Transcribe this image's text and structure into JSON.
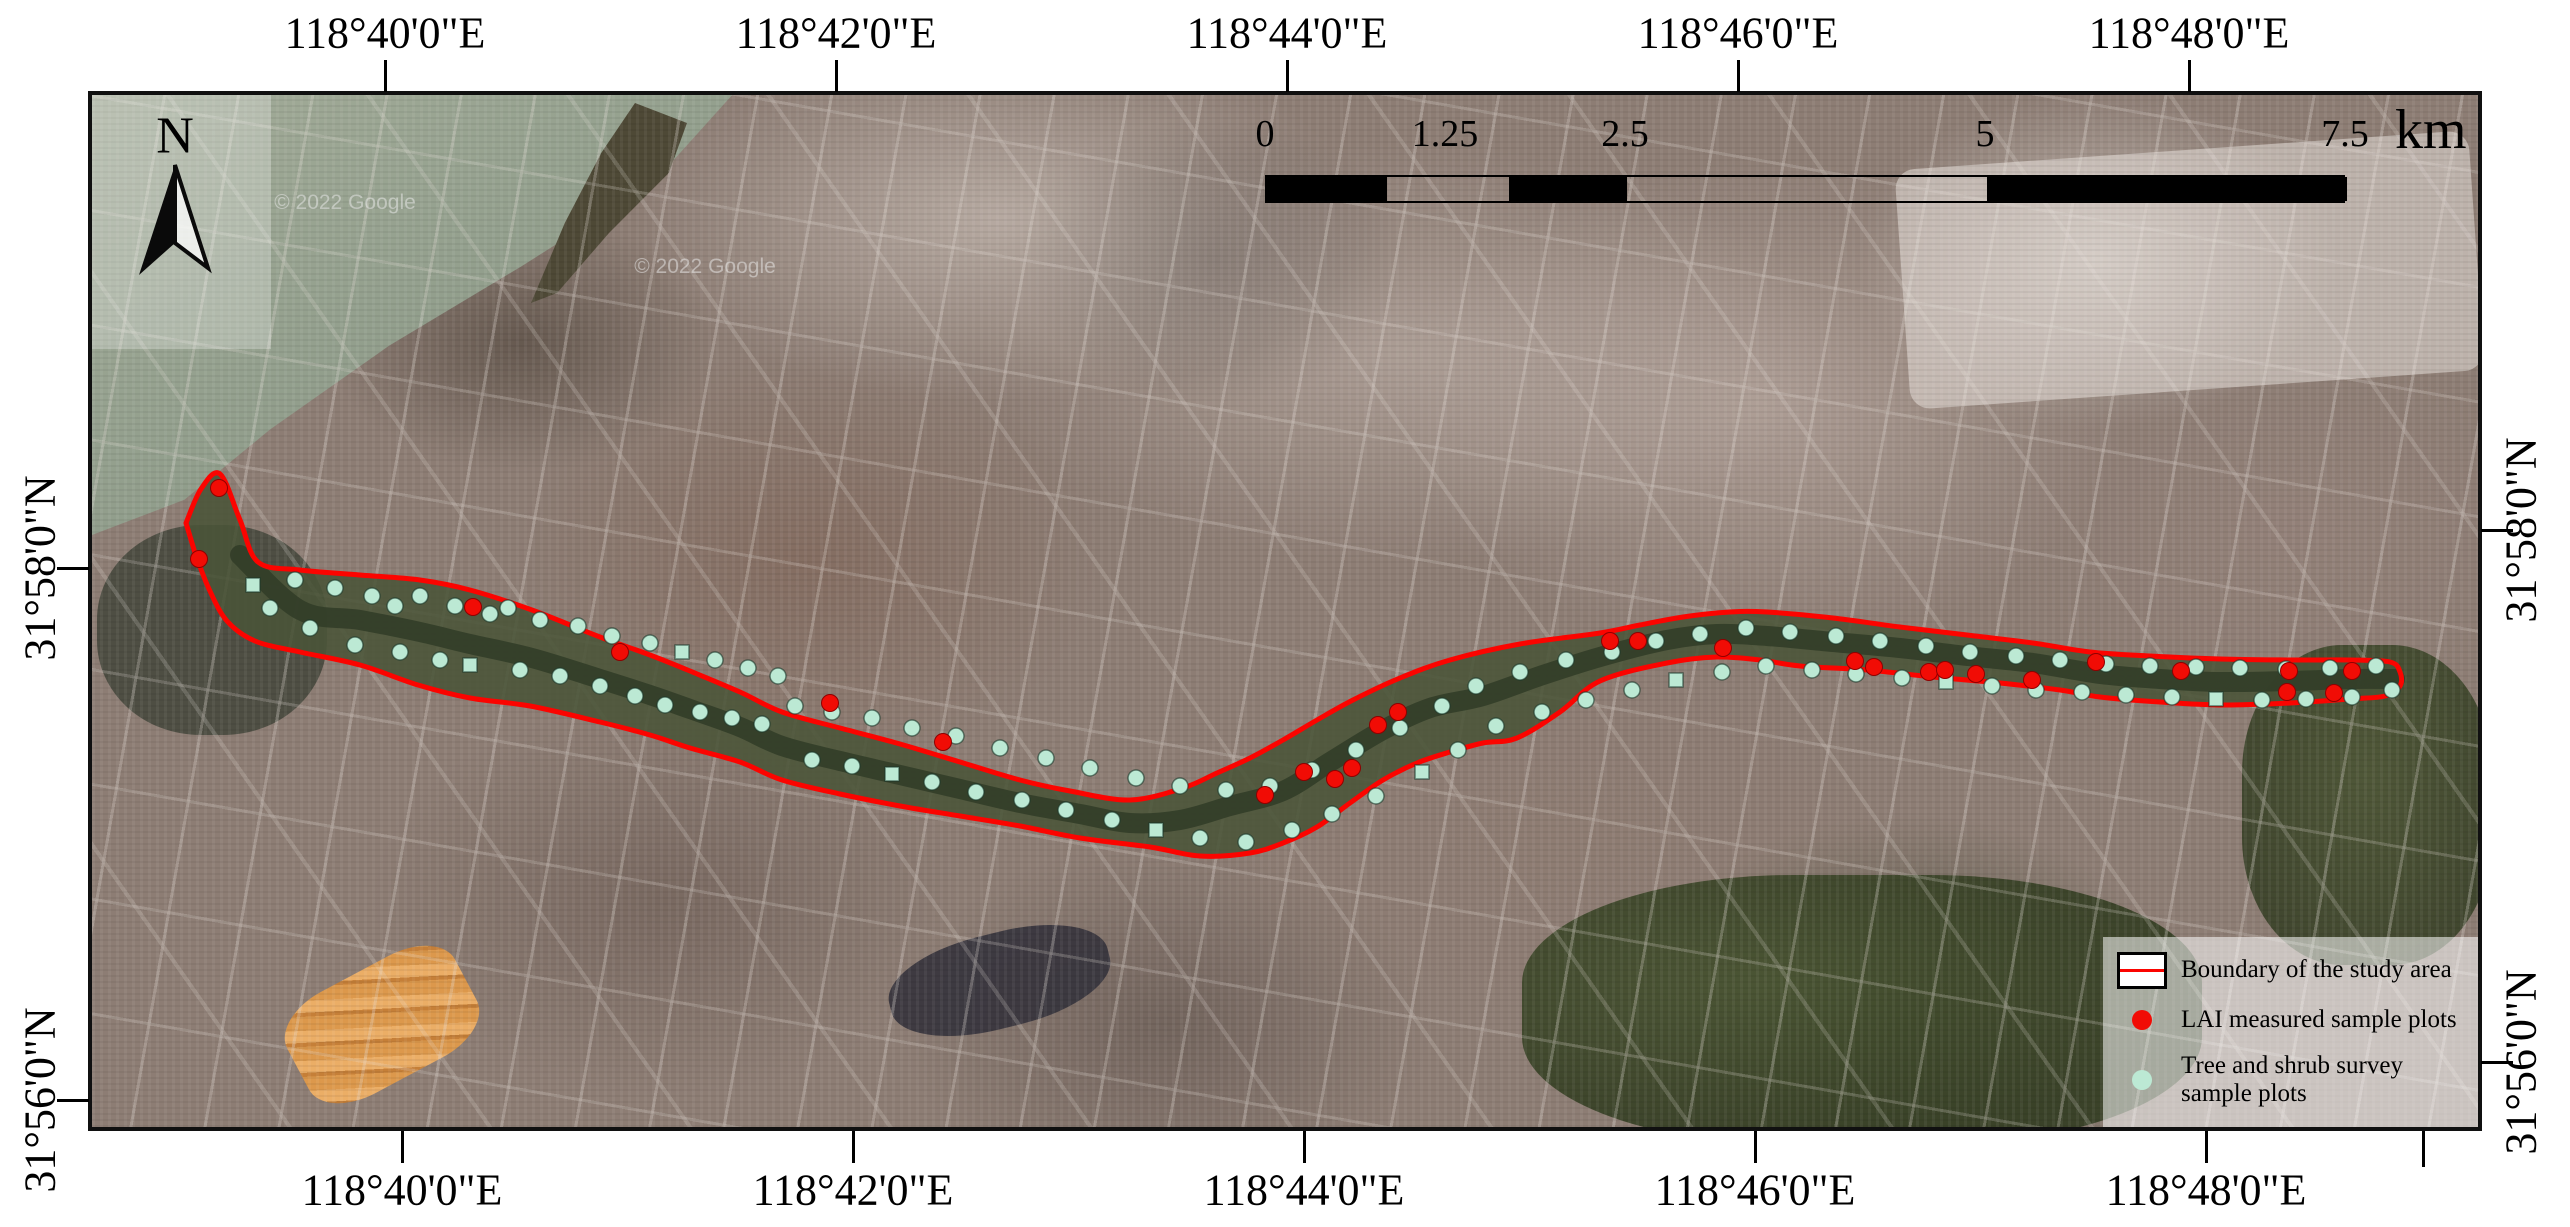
{
  "map": {
    "watermarks": [
      {
        "text": "© 2022 Google",
        "x": 345,
        "y": 203
      },
      {
        "text": "© 2022 Google",
        "x": 705,
        "y": 267
      }
    ]
  },
  "north_arrow": {
    "label": "N"
  },
  "axis": {
    "top": [
      {
        "label": "118°40'0\"E",
        "x": 385
      },
      {
        "label": "118°42'0\"E",
        "x": 836
      },
      {
        "label": "118°44'0\"E",
        "x": 1287
      },
      {
        "label": "118°46'0\"E",
        "x": 1738
      },
      {
        "label": "118°48'0\"E",
        "x": 2189
      }
    ],
    "bottom": [
      {
        "label": "118°40'0\"E",
        "x": 402
      },
      {
        "label": "118°42'0\"E",
        "x": 853
      },
      {
        "label": "118°44'0\"E",
        "x": 1304
      },
      {
        "label": "118°46'0\"E",
        "x": 1755
      },
      {
        "label": "118°48'0\"E",
        "x": 2206
      }
    ],
    "left": [
      {
        "label": "31°58'0\"N",
        "y": 568
      },
      {
        "label": "31°56'0\"N",
        "y": 1100
      }
    ],
    "right": [
      {
        "label": "31°58'0\"N",
        "y": 530
      },
      {
        "label": "31°56'0\"N",
        "y": 1062
      }
    ],
    "extra_bottom_ticks": [
      2423
    ]
  },
  "scalebar": {
    "unit": "km",
    "bar": {
      "x1": 1265,
      "x2": 2345,
      "y": 175,
      "h": 28
    },
    "labels": [
      {
        "text": "0",
        "x": 1265
      },
      {
        "text": "1.25",
        "x": 1445
      },
      {
        "text": "2.5",
        "x": 1625
      },
      {
        "text": "5",
        "x": 1985
      },
      {
        "text": "7.5",
        "x": 2345
      }
    ],
    "segments": [
      {
        "from": 1265,
        "to": 1385,
        "fill": "black"
      },
      {
        "from": 1385,
        "to": 1507,
        "fill": "none"
      },
      {
        "from": 1507,
        "to": 1625,
        "fill": "black"
      },
      {
        "from": 1625,
        "to": 1985,
        "fill": "none"
      },
      {
        "from": 1985,
        "to": 2345,
        "fill": "black"
      }
    ]
  },
  "legend": {
    "items": [
      {
        "swatch": "boundary",
        "label": "Boundary of the study area"
      },
      {
        "swatch": "lai-dot",
        "label": "LAI measured sample plots"
      },
      {
        "swatch": "tree-dot",
        "label": "Tree and shrub survey sample plots"
      }
    ]
  },
  "colors": {
    "boundary": "#fb0400",
    "lai": "#f10c05",
    "tree_shrub": "#bce9d4",
    "corridor": "#4a5438",
    "river": "#323d28",
    "frame": "#101010"
  },
  "study_area": {
    "boundary_top": [
      [
        186,
        523
      ],
      [
        201,
        489
      ],
      [
        220,
        474
      ],
      [
        240,
        520
      ],
      [
        258,
        562
      ],
      [
        300,
        570
      ],
      [
        360,
        575
      ],
      [
        420,
        580
      ],
      [
        470,
        590
      ],
      [
        532,
        610
      ],
      [
        600,
        637
      ],
      [
        650,
        655
      ],
      [
        690,
        671
      ],
      [
        740,
        692
      ],
      [
        782,
        712
      ],
      [
        840,
        728
      ],
      [
        900,
        744
      ],
      [
        960,
        762
      ],
      [
        1020,
        780
      ],
      [
        1070,
        791
      ],
      [
        1130,
        800
      ],
      [
        1183,
        788
      ],
      [
        1217,
        773
      ],
      [
        1250,
        758
      ],
      [
        1283,
        740
      ],
      [
        1317,
        720
      ],
      [
        1353,
        700
      ],
      [
        1400,
        678
      ],
      [
        1450,
        660
      ],
      [
        1520,
        644
      ],
      [
        1600,
        633
      ],
      [
        1640,
        625
      ],
      [
        1683,
        617
      ],
      [
        1730,
        612
      ],
      [
        1767,
        612
      ],
      [
        1833,
        618
      ],
      [
        1900,
        627
      ],
      [
        1967,
        635
      ],
      [
        2033,
        643
      ],
      [
        2090,
        652
      ],
      [
        2150,
        656
      ],
      [
        2220,
        659
      ],
      [
        2290,
        660
      ],
      [
        2350,
        660
      ],
      [
        2390,
        662
      ],
      [
        2400,
        672
      ]
    ],
    "boundary_bottom": [
      [
        195,
        553
      ],
      [
        209,
        589
      ],
      [
        227,
        621
      ],
      [
        255,
        641
      ],
      [
        300,
        652
      ],
      [
        360,
        665
      ],
      [
        418,
        685
      ],
      [
        470,
        698
      ],
      [
        530,
        706
      ],
      [
        600,
        722
      ],
      [
        650,
        735
      ],
      [
        690,
        748
      ],
      [
        740,
        762
      ],
      [
        782,
        780
      ],
      [
        840,
        794
      ],
      [
        900,
        806
      ],
      [
        960,
        816
      ],
      [
        1020,
        826
      ],
      [
        1080,
        838
      ],
      [
        1150,
        847
      ],
      [
        1200,
        856
      ],
      [
        1250,
        853
      ],
      [
        1283,
        843
      ],
      [
        1317,
        827
      ],
      [
        1350,
        803
      ],
      [
        1383,
        780
      ],
      [
        1417,
        763
      ],
      [
        1450,
        752
      ],
      [
        1483,
        743
      ],
      [
        1517,
        738
      ],
      [
        1560,
        712
      ],
      [
        1600,
        681
      ],
      [
        1667,
        663
      ],
      [
        1717,
        657
      ],
      [
        1760,
        660
      ],
      [
        1800,
        666
      ],
      [
        1867,
        670
      ],
      [
        1933,
        677
      ],
      [
        2000,
        683
      ],
      [
        2060,
        690
      ],
      [
        2100,
        697
      ],
      [
        2160,
        702
      ],
      [
        2220,
        705
      ],
      [
        2290,
        703
      ],
      [
        2350,
        699
      ],
      [
        2385,
        696
      ],
      [
        2400,
        686
      ]
    ],
    "river_center": [
      [
        240,
        555
      ],
      [
        300,
        610
      ],
      [
        360,
        620
      ],
      [
        420,
        632
      ],
      [
        470,
        644
      ],
      [
        532,
        658
      ],
      [
        600,
        679
      ],
      [
        650,
        695
      ],
      [
        690,
        709
      ],
      [
        740,
        727
      ],
      [
        782,
        746
      ],
      [
        840,
        761
      ],
      [
        900,
        775
      ],
      [
        960,
        789
      ],
      [
        1020,
        803
      ],
      [
        1080,
        814
      ],
      [
        1130,
        823
      ],
      [
        1180,
        820
      ],
      [
        1230,
        806
      ],
      [
        1283,
        791
      ],
      [
        1330,
        762
      ],
      [
        1383,
        730
      ],
      [
        1430,
        708
      ],
      [
        1483,
        696
      ],
      [
        1540,
        676
      ],
      [
        1600,
        657
      ],
      [
        1667,
        640
      ],
      [
        1717,
        634
      ],
      [
        1767,
        636
      ],
      [
        1833,
        642
      ],
      [
        1900,
        648
      ],
      [
        1967,
        656
      ],
      [
        2033,
        663
      ],
      [
        2100,
        674
      ],
      [
        2160,
        679
      ],
      [
        2220,
        682
      ],
      [
        2290,
        681
      ],
      [
        2350,
        679
      ],
      [
        2395,
        679
      ]
    ]
  },
  "sample_plots": {
    "lai": [
      [
        219,
        488
      ],
      [
        199,
        559
      ],
      [
        473,
        607
      ],
      [
        620,
        652
      ],
      [
        830,
        703
      ],
      [
        943,
        742
      ],
      [
        1265,
        795
      ],
      [
        1304,
        772
      ],
      [
        1335,
        779
      ],
      [
        1352,
        768
      ],
      [
        1378,
        725
      ],
      [
        1398,
        712
      ],
      [
        1610,
        641
      ],
      [
        1638,
        641
      ],
      [
        1723,
        648
      ],
      [
        1855,
        661
      ],
      [
        1874,
        667
      ],
      [
        1929,
        672
      ],
      [
        1945,
        670
      ],
      [
        1976,
        674
      ],
      [
        2032,
        680
      ],
      [
        2096,
        662
      ],
      [
        2181,
        671
      ],
      [
        2289,
        671
      ],
      [
        2352,
        671
      ],
      [
        2287,
        692
      ],
      [
        2334,
        693
      ]
    ],
    "tree_shrub": [
      [
        253,
        585
      ],
      [
        270,
        608
      ],
      [
        295,
        580
      ],
      [
        310,
        628
      ],
      [
        335,
        588
      ],
      [
        355,
        645
      ],
      [
        372,
        596
      ],
      [
        395,
        606
      ],
      [
        400,
        652
      ],
      [
        420,
        596
      ],
      [
        440,
        660
      ],
      [
        455,
        606
      ],
      [
        470,
        665
      ],
      [
        490,
        614
      ],
      [
        508,
        608
      ],
      [
        520,
        670
      ],
      [
        540,
        620
      ],
      [
        560,
        676
      ],
      [
        578,
        626
      ],
      [
        600,
        686
      ],
      [
        612,
        636
      ],
      [
        635,
        696
      ],
      [
        650,
        643
      ],
      [
        665,
        705
      ],
      [
        682,
        652
      ],
      [
        700,
        712
      ],
      [
        715,
        660
      ],
      [
        732,
        718
      ],
      [
        748,
        668
      ],
      [
        762,
        724
      ],
      [
        778,
        676
      ],
      [
        795,
        706
      ],
      [
        812,
        760
      ],
      [
        832,
        712
      ],
      [
        852,
        766
      ],
      [
        872,
        718
      ],
      [
        892,
        774
      ],
      [
        912,
        728
      ],
      [
        932,
        782
      ],
      [
        956,
        736
      ],
      [
        976,
        792
      ],
      [
        1000,
        748
      ],
      [
        1022,
        800
      ],
      [
        1046,
        758
      ],
      [
        1066,
        810
      ],
      [
        1090,
        768
      ],
      [
        1112,
        820
      ],
      [
        1136,
        778
      ],
      [
        1156,
        830
      ],
      [
        1180,
        786
      ],
      [
        1200,
        838
      ],
      [
        1226,
        790
      ],
      [
        1246,
        842
      ],
      [
        1270,
        786
      ],
      [
        1292,
        830
      ],
      [
        1312,
        770
      ],
      [
        1332,
        814
      ],
      [
        1356,
        750
      ],
      [
        1376,
        796
      ],
      [
        1400,
        728
      ],
      [
        1422,
        772
      ],
      [
        1442,
        706
      ],
      [
        1458,
        750
      ],
      [
        1476,
        686
      ],
      [
        1496,
        726
      ],
      [
        1520,
        672
      ],
      [
        1542,
        712
      ],
      [
        1566,
        660
      ],
      [
        1586,
        700
      ],
      [
        1612,
        652
      ],
      [
        1632,
        690
      ],
      [
        1656,
        641
      ],
      [
        1676,
        680
      ],
      [
        1700,
        634
      ],
      [
        1722,
        672
      ],
      [
        1746,
        628
      ],
      [
        1766,
        666
      ],
      [
        1790,
        632
      ],
      [
        1812,
        670
      ],
      [
        1836,
        636
      ],
      [
        1856,
        674
      ],
      [
        1880,
        641
      ],
      [
        1902,
        678
      ],
      [
        1926,
        646
      ],
      [
        1946,
        682
      ],
      [
        1970,
        652
      ],
      [
        1992,
        686
      ],
      [
        2016,
        656
      ],
      [
        2036,
        690
      ],
      [
        2060,
        660
      ],
      [
        2082,
        692
      ],
      [
        2106,
        664
      ],
      [
        2126,
        695
      ],
      [
        2150,
        666
      ],
      [
        2172,
        697
      ],
      [
        2196,
        667
      ],
      [
        2216,
        699
      ],
      [
        2240,
        668
      ],
      [
        2262,
        700
      ],
      [
        2286,
        669
      ],
      [
        2306,
        699
      ],
      [
        2330,
        668
      ],
      [
        2352,
        697
      ],
      [
        2376,
        666
      ],
      [
        2392,
        690
      ]
    ]
  }
}
